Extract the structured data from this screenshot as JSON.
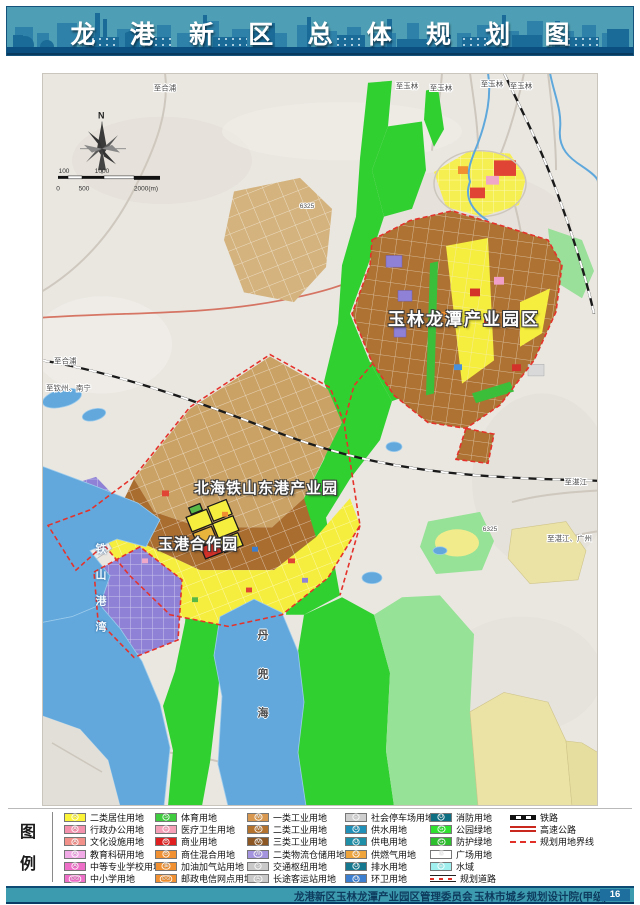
{
  "header": {
    "title": "龙 港 新 区 总 体 规 划 图"
  },
  "theme": {
    "header_bg": "#4E9FB5",
    "header_band": "#0B4F80",
    "footer_bg": "#3D9BB0",
    "page_box": "#1E6E9E",
    "boundary_red": "#E03028",
    "water_blue": "#62A8DC",
    "park_green": "#2FD12F",
    "industry_brown": "#AE7233",
    "residential_yellow": "#F6EE3E"
  },
  "map": {
    "compass_n": "N",
    "scale": {
      "t100": "100",
      "t1000": "1000",
      "t0": "0",
      "t500": "500",
      "t2000": "2000(m)"
    },
    "area_labels": {
      "ylpark": "玉林龙潭产业园区",
      "bhpark": "北海铁山东港产业园",
      "ygpark": "玉港合作园",
      "bay": "铁山港湾",
      "dandou": "丹兜海"
    },
    "road_labels": {
      "r1": "至合浦",
      "r2": "至玉林",
      "r3": "至玉林",
      "r4": "至玉林",
      "r5": "至玉林",
      "r6": "至合浦",
      "r7": "至钦州、南宁",
      "r8": "至湛江",
      "r9": "至湛江、广州",
      "r10": "6325",
      "r11": "6325"
    }
  },
  "legend": {
    "title_chars": {
      "c1": "图",
      "c2": "例"
    },
    "columns": [
      {
        "items": [
          {
            "label": "二类居住用地",
            "color": "#FCF438",
            "sym": "R"
          },
          {
            "label": "行政办公用地",
            "color": "#F492AE",
            "sym": "A"
          },
          {
            "label": "文化设施用地",
            "color": "#F2908A",
            "sym": "A"
          },
          {
            "label": "教育科研用地",
            "color": "#F2AAE6",
            "sym": "A"
          },
          {
            "label": "中等专业学校用地",
            "color": "#EE6FC8",
            "sym": "A"
          },
          {
            "label": "中小学用地",
            "color": "#EE6FC8",
            "sym": "⊙⊙"
          }
        ]
      },
      {
        "items": [
          {
            "label": "体育用地",
            "color": "#3FCC3F",
            "sym": "S"
          },
          {
            "label": "医疗卫生用地",
            "color": "#F6A0B8",
            "sym": "+"
          },
          {
            "label": "商业用地",
            "color": "#E02020",
            "sym": "B"
          },
          {
            "label": "商住混合用地",
            "color": "#F09030",
            "sym": "B"
          },
          {
            "label": "加油加气站用地",
            "color": "#F09030",
            "sym": "油"
          },
          {
            "label": "邮政电信网点用地",
            "color": "#F09030",
            "sym": "⊙⊙"
          }
        ]
      },
      {
        "items": [
          {
            "label": "一类工业用地",
            "color": "#D89850",
            "sym": "M"
          },
          {
            "label": "二类工业用地",
            "color": "#B4722F",
            "sym": "M"
          },
          {
            "label": "三类工业用地",
            "color": "#8C5722",
            "sym": "M"
          },
          {
            "label": "二类物流仓储用地",
            "color": "#A493DE",
            "sym": "W"
          },
          {
            "label": "交通枢纽用地",
            "color": "#C9C9C9",
            "sym": "S"
          },
          {
            "label": "长途客运站用地",
            "color": "#C9C9C9",
            "sym": "客"
          }
        ]
      },
      {
        "items": [
          {
            "label": "社会停车场用地",
            "color": "#CFCFCF",
            "sym": "P"
          },
          {
            "label": "供水用地",
            "color": "#2090B8",
            "sym": "U"
          },
          {
            "label": "供电用地",
            "color": "#1F8FA8",
            "sym": "U"
          },
          {
            "label": "供燃气用地",
            "color": "#F0A43C",
            "sym": "U"
          },
          {
            "label": "排水用地",
            "color": "#16788E",
            "sym": "U"
          },
          {
            "label": "环卫用地",
            "color": "#3C7FD0",
            "sym": "U"
          }
        ]
      },
      {
        "items": [
          {
            "label": "消防用地",
            "color": "#0E6F82",
            "sym": "U"
          },
          {
            "label": "公园绿地",
            "color": "#2FE12F",
            "sym": "G"
          },
          {
            "label": "防护绿地",
            "color": "#2DBF2D",
            "sym": "G"
          },
          {
            "label": "广场用地",
            "color": "#FFFFFF",
            "sym": "G"
          },
          {
            "label": "水域",
            "color": "#9FEFEF",
            "sym": "E"
          },
          {
            "label": "规划道路",
            "color": "#E03028",
            "sym": ""
          }
        ]
      },
      {
        "items": [
          {
            "label": "铁路",
            "color": "#111111",
            "sym": ""
          },
          {
            "label": "高速公路",
            "color": "#C8281E",
            "sym": ""
          },
          {
            "label": "规划用地界线",
            "color": "#E03028",
            "sym": ""
          }
        ]
      }
    ]
  },
  "footer": {
    "agency": "龙港新区玉林龙潭产业园区管理委员会",
    "designer": "玉林市城乡规划设计院(甲级)",
    "page": "16"
  }
}
